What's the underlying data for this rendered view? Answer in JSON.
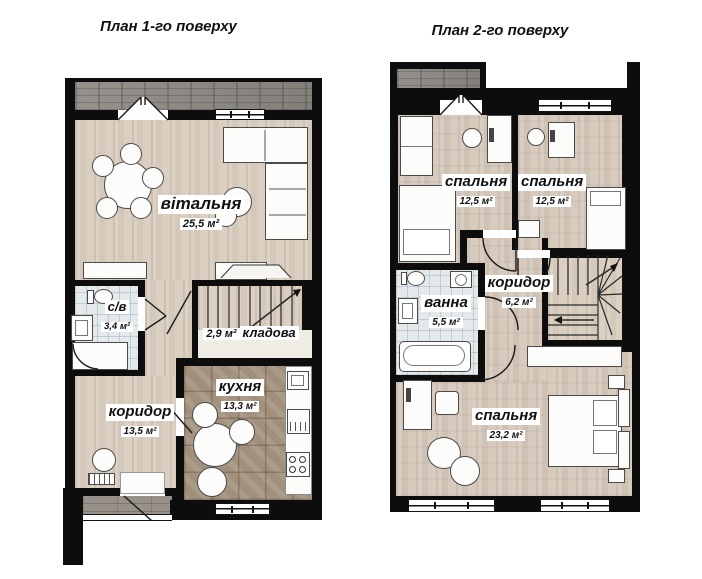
{
  "page": {
    "width": 702,
    "height": 579,
    "background": "#ffffff"
  },
  "colors": {
    "wall": "#0d0d0d",
    "wood_floor": "#d9cec0",
    "kitchen_tile": "#a2907c",
    "bath_tile": "#e4e9ec",
    "terrace_stone": "#8e8a85",
    "label_background": "#ffffff"
  },
  "floor1": {
    "title": "План 1-го поверху",
    "rooms": {
      "living": {
        "name": "вітальня",
        "area": "25,5 м²"
      },
      "bathroom": {
        "name": "с/в",
        "area": "3,4 м²"
      },
      "storage": {
        "name": "кладова",
        "area": "2,9 м²"
      },
      "kitchen": {
        "name": "кухня",
        "area": "13,3 м²"
      },
      "corridor": {
        "name": "коридор",
        "area": "13,5 м²"
      }
    }
  },
  "floor2": {
    "title": "План 2-го поверху",
    "rooms": {
      "bedroom1": {
        "name": "спальня",
        "area": "12,5 м²"
      },
      "bedroom2": {
        "name": "спальня",
        "area": "12,5 м²"
      },
      "bath": {
        "name": "ванна",
        "area": "5,5 м²"
      },
      "corridor": {
        "name": "коридор",
        "area": "6,2 м²"
      },
      "bedroom3": {
        "name": "спальня",
        "area": "23,2 м²"
      }
    }
  }
}
